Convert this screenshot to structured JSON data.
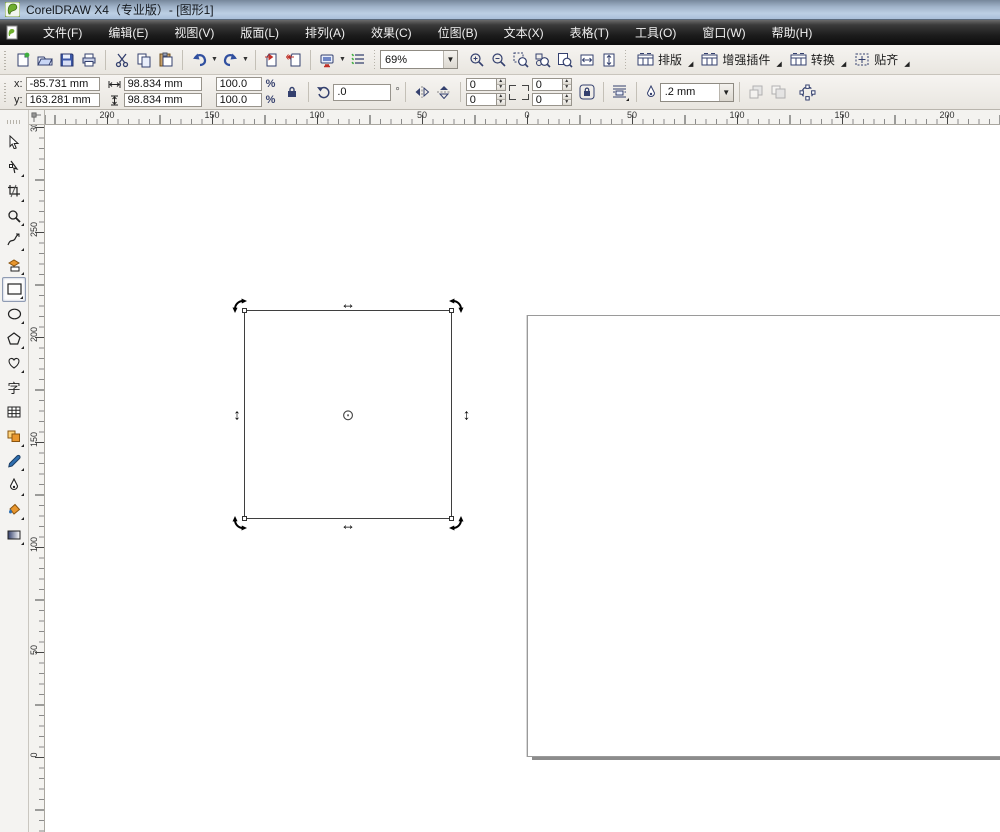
{
  "window": {
    "title": "CorelDRAW X4（专业版）- [图形1]"
  },
  "menu": {
    "items": [
      {
        "label": "文件(F)"
      },
      {
        "label": "编辑(E)"
      },
      {
        "label": "视图(V)"
      },
      {
        "label": "版面(L)"
      },
      {
        "label": "排列(A)"
      },
      {
        "label": "效果(C)"
      },
      {
        "label": "位图(B)"
      },
      {
        "label": "文本(X)"
      },
      {
        "label": "表格(T)"
      },
      {
        "label": "工具(O)"
      },
      {
        "label": "窗口(W)"
      },
      {
        "label": "帮助(H)"
      }
    ]
  },
  "toolbar": {
    "zoom_level": "69%",
    "dockers": [
      {
        "label": "排版"
      },
      {
        "label": "增强插件"
      },
      {
        "label": "转换"
      },
      {
        "label": "贴齐"
      }
    ]
  },
  "property_bar": {
    "x_label": "x:",
    "x_value": "-85.731 mm",
    "y_label": "y:",
    "y_value": "163.281 mm",
    "width_value": "98.834 mm",
    "height_value": "98.834 mm",
    "scale_h": "100.0",
    "scale_v": "100.0",
    "percent": "%",
    "rotation_value": ".0",
    "degree_symbol": "°",
    "corner_tl": "0",
    "corner_bl": "0",
    "corner_tr": "0",
    "corner_br": "0",
    "outline_width": ".2 mm"
  },
  "rulers": {
    "horizontal": {
      "labels": [
        {
          "t": "200",
          "p": 62
        },
        {
          "t": "150",
          "p": 167
        },
        {
          "t": "100",
          "p": 272
        },
        {
          "t": "50",
          "p": 377
        },
        {
          "t": "0",
          "p": 482
        },
        {
          "t": "50",
          "p": 587
        },
        {
          "t": "100",
          "p": 692
        },
        {
          "t": "150",
          "p": 797
        },
        {
          "t": "200",
          "p": 902
        }
      ]
    },
    "vertical": {
      "labels": [
        {
          "t": "300",
          "p": 2
        },
        {
          "t": "250",
          "p": 107
        },
        {
          "t": "200",
          "p": 212
        },
        {
          "t": "150",
          "p": 317
        },
        {
          "t": "100",
          "p": 422
        },
        {
          "t": "50",
          "p": 527
        },
        {
          "t": "0",
          "p": 632
        }
      ]
    }
  },
  "toolbox": {
    "text_tool_glyph": "字"
  },
  "canvas": {
    "selection": {
      "h_handle_glyph": "↔",
      "v_handle_glyph": "↕",
      "center_glyph": "⊙"
    }
  },
  "colors": {
    "accent_navy": "#34406e",
    "accent_orange": "#e8962e",
    "accent_red": "#c03028"
  }
}
